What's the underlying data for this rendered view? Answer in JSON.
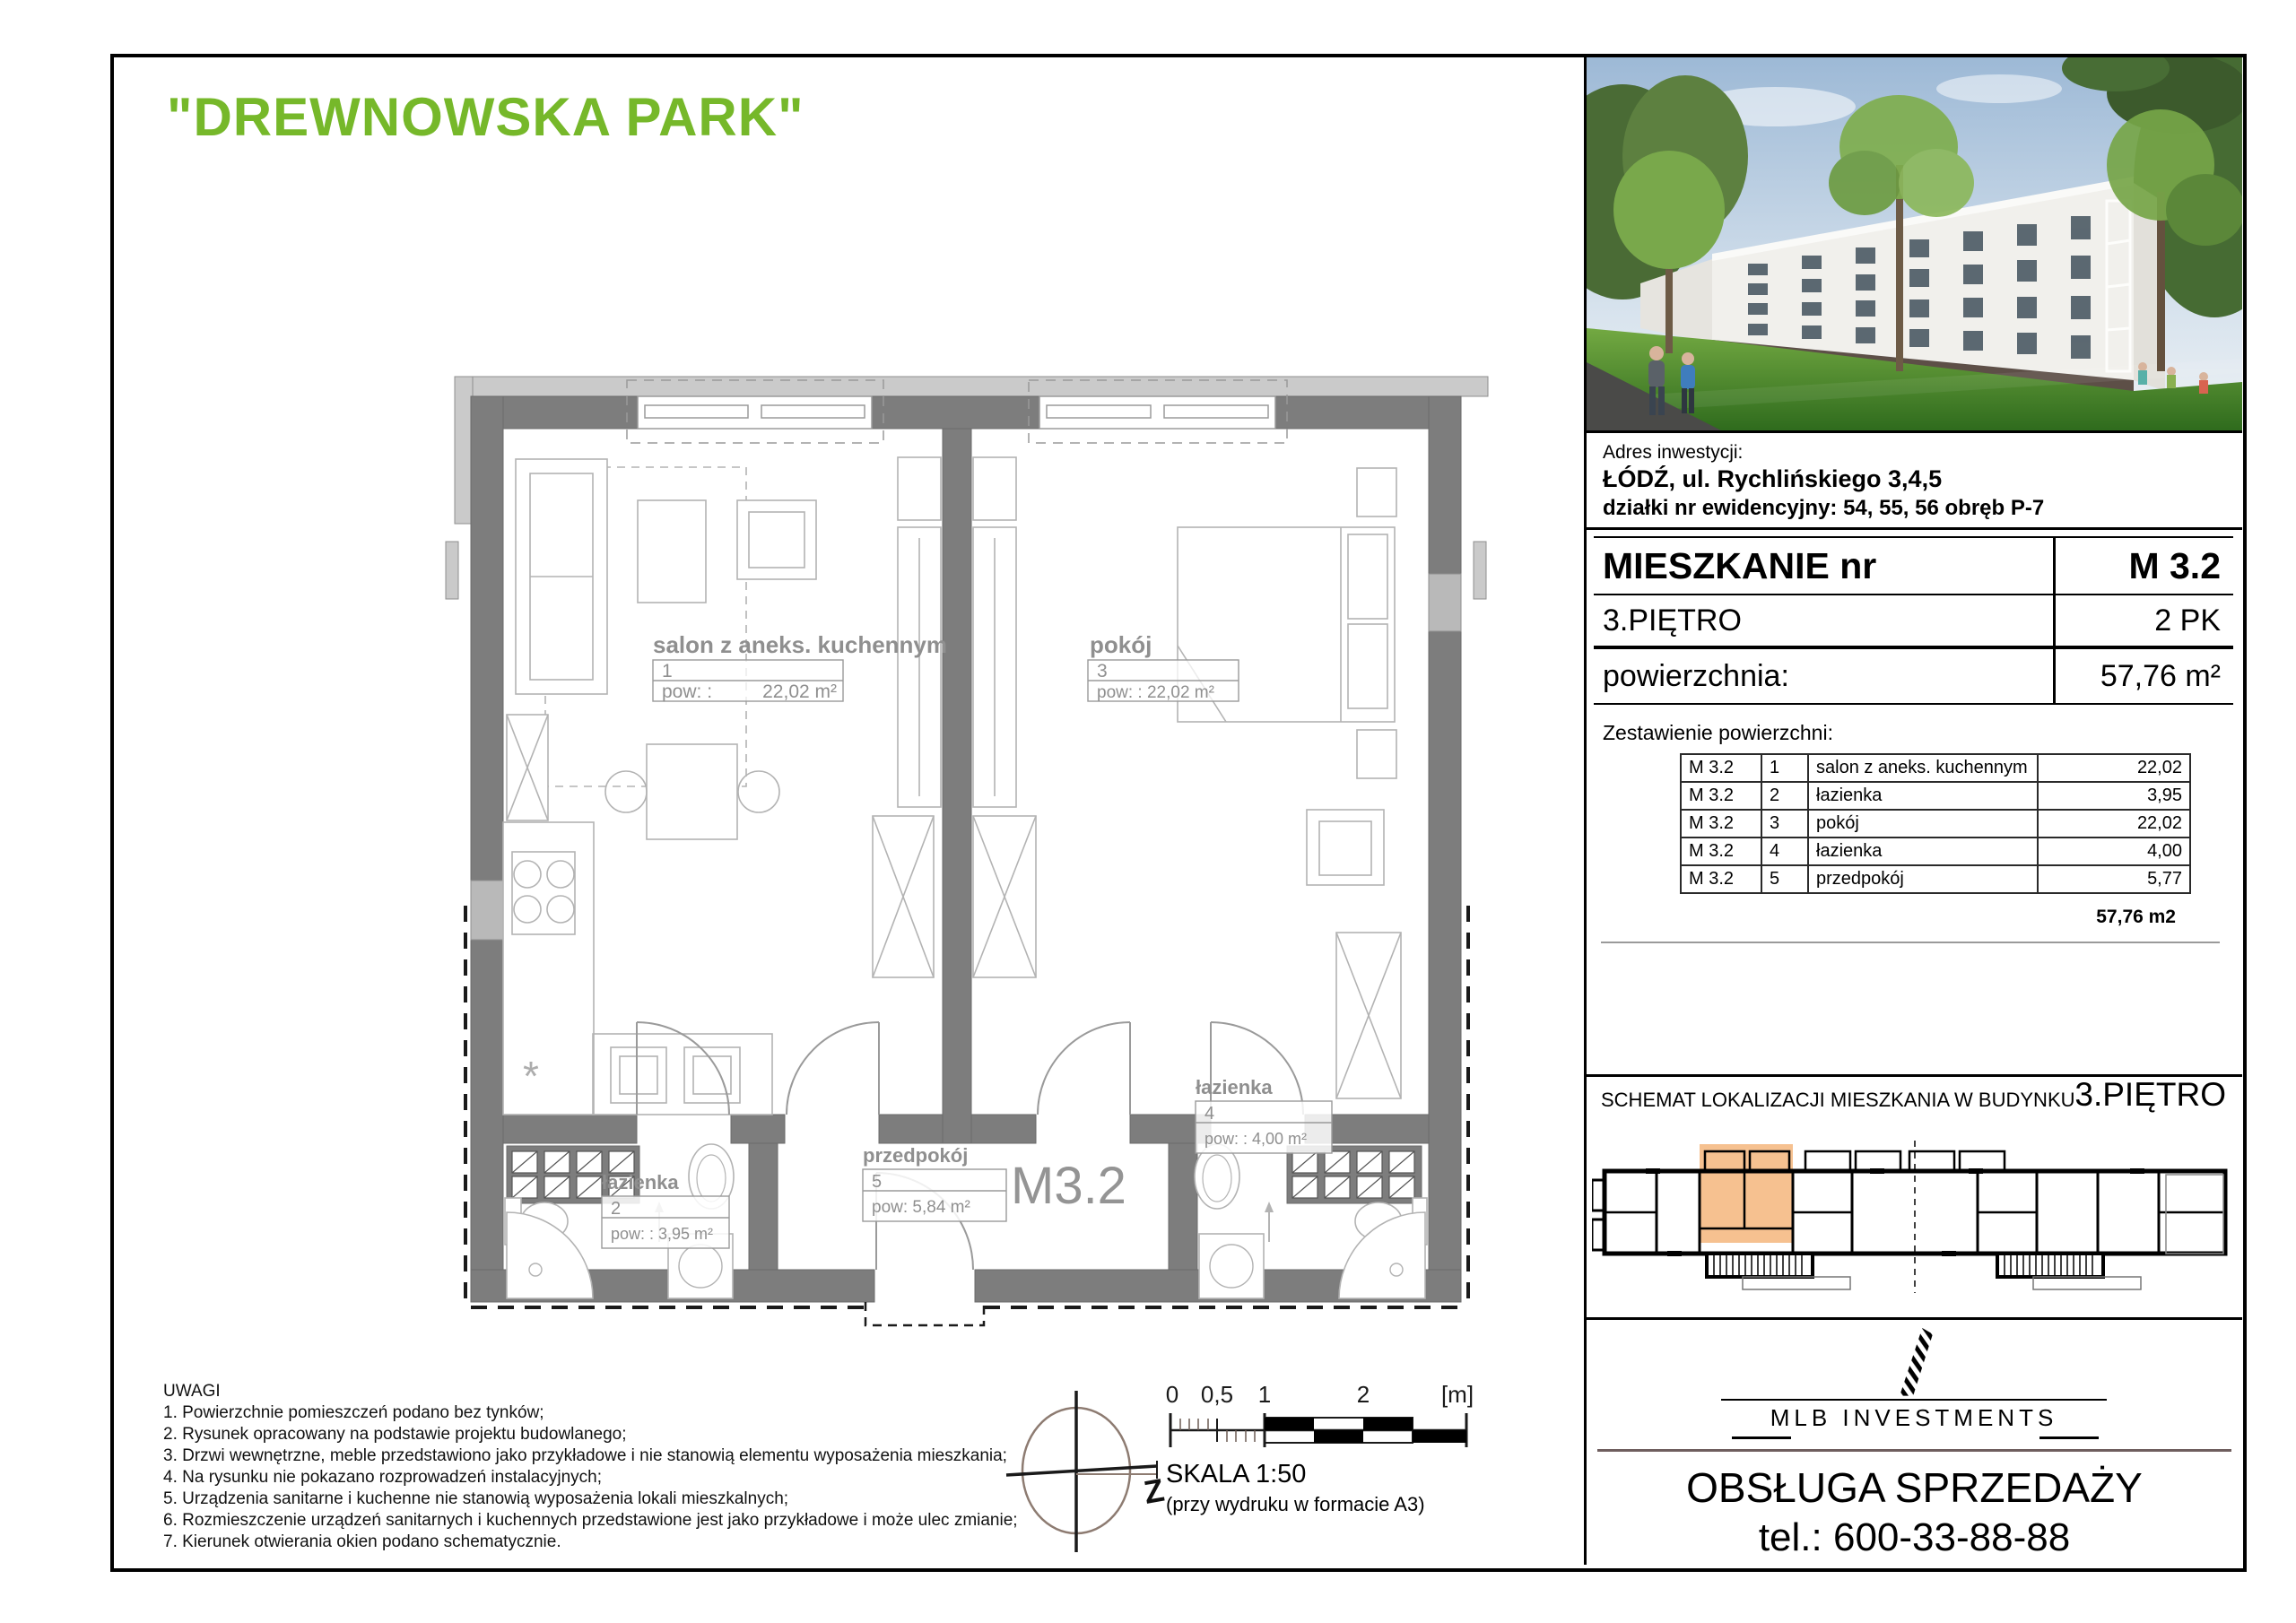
{
  "title": "\"DREWNOWSKA PARK\"",
  "address": {
    "label": "Adres inwestycji:",
    "line1": "ŁÓDŹ, ul. Rychlińskiego 3,4,5",
    "line2": "działki nr ewidencyjny: 54, 55, 56 obręb P-7"
  },
  "card": {
    "title": "MIESZKANIE nr",
    "number": "M 3.2",
    "floor": "3.PIĘTRO",
    "rooms": "2 PK",
    "area_label": "powierzchnia:",
    "area": "57,76 m²"
  },
  "area_table": {
    "heading": "Zestawienie powierzchni:",
    "rows": [
      [
        "M 3.2",
        "1",
        "salon z aneks. kuchennym",
        "22,02"
      ],
      [
        "M 3.2",
        "2",
        "łazienka",
        "3,95"
      ],
      [
        "M 3.2",
        "3",
        "pokój",
        "22,02"
      ],
      [
        "M 3.2",
        "4",
        "łazienka",
        "4,00"
      ],
      [
        "M 3.2",
        "5",
        "przedpokój",
        "5,77"
      ]
    ],
    "total": "57,76 m2"
  },
  "plan": {
    "apartment_label": "M3.2",
    "salon": {
      "name": "salon z aneks. kuchennym",
      "no": "1",
      "pow_label": "pow: :",
      "area": "22,02 m²"
    },
    "pokoj": {
      "name": "pokój",
      "no": "3",
      "pow": "pow: : 22,02 m²"
    },
    "lazienka2": {
      "name": "łazienka",
      "no": "2",
      "pow": "pow: : 3,95 m²"
    },
    "lazienka4": {
      "name": "łazienka",
      "no": "4",
      "pow": "pow: : 4,00 m²"
    },
    "przedpokoj": {
      "name": "przedpokój",
      "no": "5",
      "pow": "pow: 5,84 m²"
    }
  },
  "notes": {
    "heading": "UWAGI",
    "items": [
      "1. Powierzchnie pomieszczeń podano bez tynków;",
      "2. Rysunek opracowany na podstawie projektu budowlanego;",
      "3. Drzwi wewnętrzne, meble przedstawiono jako przykładowe i nie stanowią elementu wyposażenia mieszkania;",
      "4. Na rysunku nie pokazano rozprowadzeń instalacyjnych;",
      "5. Urządzenia sanitarne i kuchenne nie stanowią wyposażenia lokali mieszkalnych;",
      "6. Rozmieszczenie urządzeń sanitarnych i kuchennych przedstawione jest jako przykładowe i może ulec zmianie;",
      "7. Kierunek otwierania okien podano schematycznie."
    ]
  },
  "scale": {
    "ticks": [
      "0",
      "0,5",
      "1",
      "2",
      "[m]"
    ],
    "skala": "SKALA 1:50",
    "note": "(przy wydruku w formacie A3)",
    "compass": "Z"
  },
  "schemat": {
    "title": "SCHEMAT LOKALIZACJI MIESZKANIA W BUDYNKU",
    "floor": "3.PIĘTRO"
  },
  "footer": {
    "brand": "MLB INVESTMENTS",
    "sales": "OBSŁUGA SPRZEDAŻY",
    "phone": "tel.: 600-33-88-88"
  },
  "colors": {
    "accent_green": "#76b82a",
    "highlight_orange": "#f6c190",
    "wall_gray": "#7d7d7d"
  }
}
